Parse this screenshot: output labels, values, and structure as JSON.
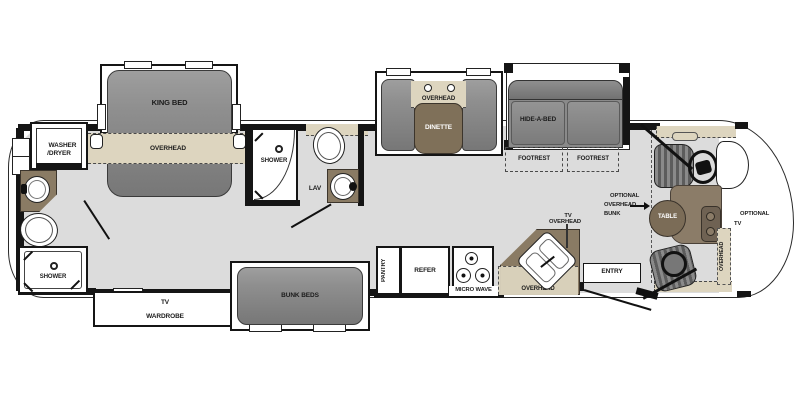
{
  "plan_title": "motorhome-floorplan",
  "bedroom": {
    "king_bed": "KING BED",
    "overhead": "OVERHEAD"
  },
  "rear_bath": {
    "washer_line1": "WASHER",
    "washer_line2": "/DRYER",
    "shower": "SHOWER"
  },
  "wardrobe_unit": {
    "tv": "TV",
    "wardrobe": "WARDROBE"
  },
  "mid_bath": {
    "shower": "SHOWER",
    "lav": "LAV"
  },
  "bunk_room": {
    "bunk_beds": "BUNK BEDS"
  },
  "dinette": {
    "overhead": "OVERHEAD",
    "table": "DINETTE"
  },
  "living": {
    "sofa": "HIDE-A-BED",
    "footrest_left": "FOOTREST",
    "footrest_right": "FOOTREST"
  },
  "galley": {
    "pantry": "PANTRY",
    "refer": "REFER",
    "microwave": "MICRO WAVE",
    "tv_overhead_line1": "TV",
    "tv_overhead_line2": "OVERHEAD",
    "overhead": "OVERHEAD"
  },
  "entry": {
    "label": "ENTRY"
  },
  "cockpit": {
    "opt_bunk_line1": "OPTIONAL",
    "opt_bunk_line2": "OVERHEAD",
    "opt_bunk_line3": "BUNK",
    "table": "TABLE",
    "opt_tv_line1": "OPTIONAL",
    "opt_tv_line2": "TV",
    "overhead_band": "OVERHEAD"
  },
  "colors": {
    "floor": "#dcdcdc",
    "wall": "#151515",
    "overhead_band": "#ddd5bf",
    "counter_brown": "#8a7b64",
    "furniture_gray": "#8a8a8a",
    "table_brown": "#7b6c57"
  }
}
